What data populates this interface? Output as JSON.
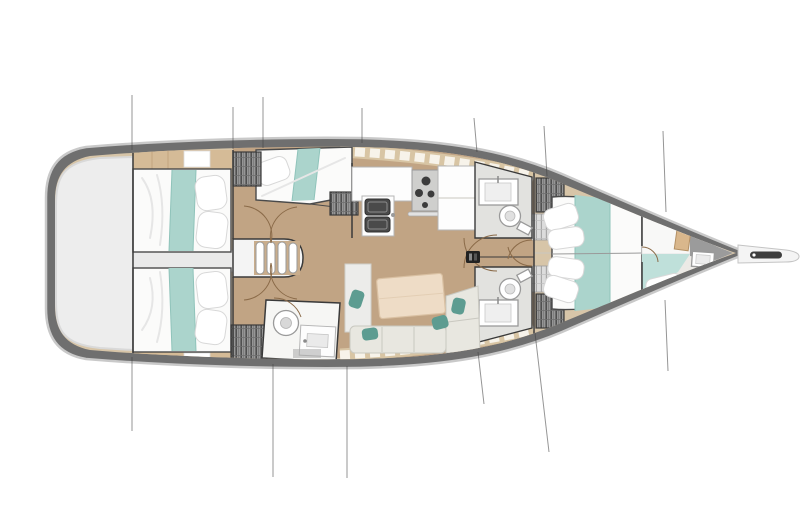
{
  "meta": {
    "title": "Sailboat interior layout floor plan",
    "view": "top-down",
    "orientation": "bow-right",
    "background": "#ffffff"
  },
  "colors": {
    "hullBand": "#6f6f6f",
    "hullEdge": "#c9c9c9",
    "deckWood": "#d7c5a8",
    "floorTan": "#c1a484",
    "cockpitGray": "#ededed",
    "passageGray": "#e9e9e9",
    "teal": "#abd4cc",
    "tealLight": "#bfe0da",
    "tealPillow": "#5d9c91",
    "bedWhite": "#fbfbfa",
    "woodTrim": "#d5bb97",
    "tableWood": "#eedcc6",
    "settee": "#e8e7e0",
    "hatchDark": "#969696",
    "hatchLight": "#dcdcdc",
    "applianceDark": "#4a4a4a",
    "stoveGray": "#cfcfcd",
    "outline": "#3d3d3d",
    "rigging": "#3f3f3f",
    "mast": "#222222",
    "tile": "#f7f3ea",
    "bowsprit": "#f4f4f4"
  },
  "inventory": {
    "cabins": [
      {
        "id": "aft-cabin-port",
        "berth": "double",
        "accent": "teal-runner"
      },
      {
        "id": "aft-cabin-starboard",
        "berth": "double",
        "accent": "teal-runner"
      },
      {
        "id": "bunk-cabin-port",
        "berth": "single",
        "accent": "teal-runner"
      },
      {
        "id": "forward-cabin",
        "berth": "double-v",
        "accent": "teal-runner"
      },
      {
        "id": "bow-compartment",
        "berth": "single",
        "accent": "teal-cover"
      }
    ],
    "heads": [
      {
        "id": "aft-head",
        "fixtures": [
          "toilet",
          "sink",
          "shower"
        ]
      },
      {
        "id": "mid-head-port",
        "fixtures": [
          "toilet",
          "sink"
        ]
      },
      {
        "id": "mid-head-starboard",
        "fixtures": [
          "toilet",
          "sink"
        ]
      },
      {
        "id": "bow-head",
        "fixtures": [
          "toilet",
          "sink"
        ]
      }
    ],
    "galley": {
      "sinks": 2,
      "stove_burners": 4,
      "counters": 3
    },
    "salon": {
      "tables": 1,
      "settee_sections": 3,
      "throw_pillows": 4
    },
    "companionway_steps": 4,
    "wardrobes_hatched": 5,
    "rigging_lines": 13,
    "mast_count": 1,
    "bowsprit_count": 1
  }
}
